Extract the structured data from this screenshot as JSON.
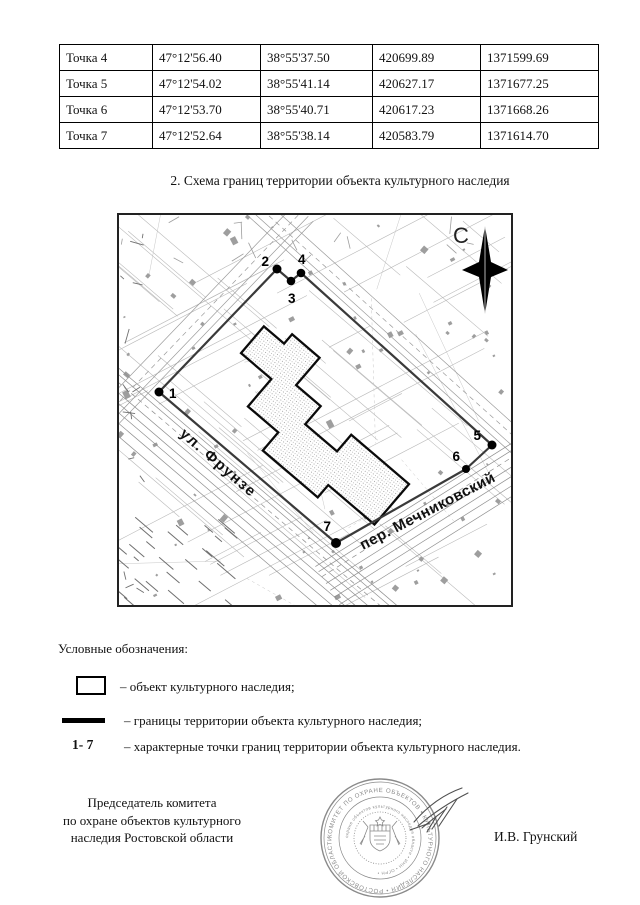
{
  "document": {
    "section_title": "2. Схема границ территории объекта культурного наследия"
  },
  "coordinates_table": {
    "rows": [
      {
        "cells": [
          "Точка 4",
          "47°12'56.40",
          "38°55'37.50",
          "420699.89",
          "1371599.69"
        ]
      },
      {
        "cells": [
          "Точка 5",
          "47°12'54.02",
          "38°55'41.14",
          "420627.17",
          "1371677.25"
        ]
      },
      {
        "cells": [
          "Точка 6",
          "47°12'53.70",
          "38°55'40.71",
          "420617.23",
          "1371668.26"
        ]
      },
      {
        "cells": [
          "Точка 7",
          "47°12'52.64",
          "38°55'38.14",
          "420583.79",
          "1371614.70"
        ]
      }
    ]
  },
  "map": {
    "compass_label": "С",
    "streets": {
      "frunze": "ул. Фрунзе",
      "mechnikovsky": "пер. Мечниковский"
    },
    "points": [
      {
        "label": "1"
      },
      {
        "label": "2"
      },
      {
        "label": "3"
      },
      {
        "label": "4"
      },
      {
        "label": "5"
      },
      {
        "label": "6"
      },
      {
        "label": "7"
      }
    ],
    "colors": {
      "boundary": "#3a3a3a",
      "background_lines": "#b5b5b5",
      "building_outline": "#0a0a0a"
    }
  },
  "legend": {
    "title": "Условные обозначения:",
    "items": [
      {
        "symbol": "rectangle",
        "label": "– объект культурного наследия;"
      },
      {
        "symbol": "thick-line",
        "label": "– границы территории объекта культурного наследия;"
      },
      {
        "symbol": "1- 7",
        "label": "– характерные точки границ территории объекта культурного наследия."
      }
    ],
    "points_range": "1- 7"
  },
  "signature": {
    "position_lines": [
      "Председатель комитета",
      "по охране объектов культурного",
      "наследия Ростовской области"
    ],
    "name": "И.В. Грунский",
    "stamp": {
      "color": "#8a8a8a",
      "outer_ring_text": "КОМИТЕТ ПО ОХРАНЕ ОБЪЕКТОВ • КУЛЬТУРНОГО НАСЛЕДИЯ • РОСТОВСКОЙ ОБЛАСТИ •",
      "inner_ring_text": "охране объектов культурного наследия области • ИНН • ОГРН •"
    }
  }
}
